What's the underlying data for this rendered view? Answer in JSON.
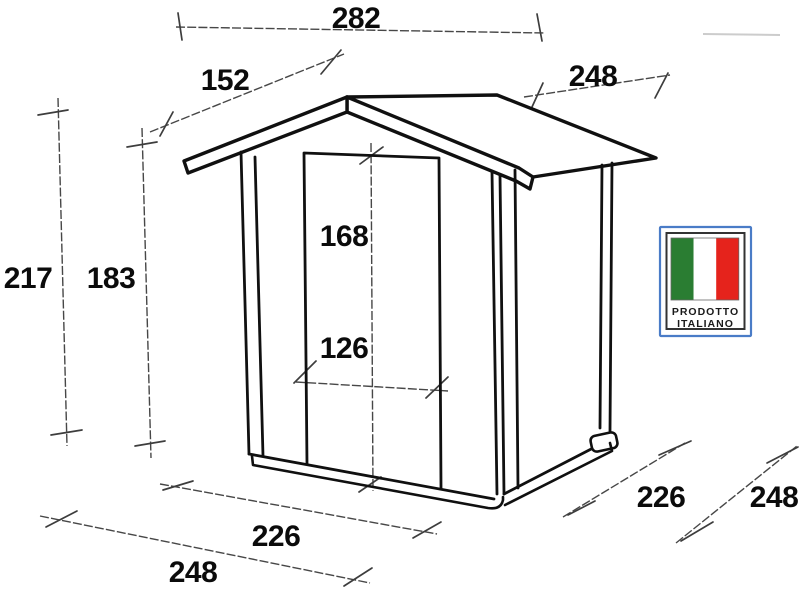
{
  "drawing": {
    "type": "technical-dimension-drawing",
    "subject": "wooden garden shed with gable roof and full-height front door",
    "dimensions": {
      "top_width": "282",
      "roof_slope_left": "152",
      "roof_side_depth": "248",
      "total_height": "217",
      "wall_height": "183",
      "door_height": "168",
      "door_width": "126",
      "base_front_width": "226",
      "base_front_overall": "248",
      "base_side_depth": "226",
      "base_side_overall": "248"
    }
  },
  "badge": {
    "line1": "PRODOTTO",
    "line2": "ITALIANO",
    "colors": {
      "border_blue": "#4a7cc7",
      "frame_dark": "#333333",
      "flag_green": "#2a7d32",
      "flag_white": "#ffffff",
      "flag_red": "#e5231c"
    }
  },
  "colors": {
    "shed_line": "#101010",
    "dimension_line": "#474747",
    "number_text": "#0b0b0b",
    "background": "#ffffff"
  }
}
